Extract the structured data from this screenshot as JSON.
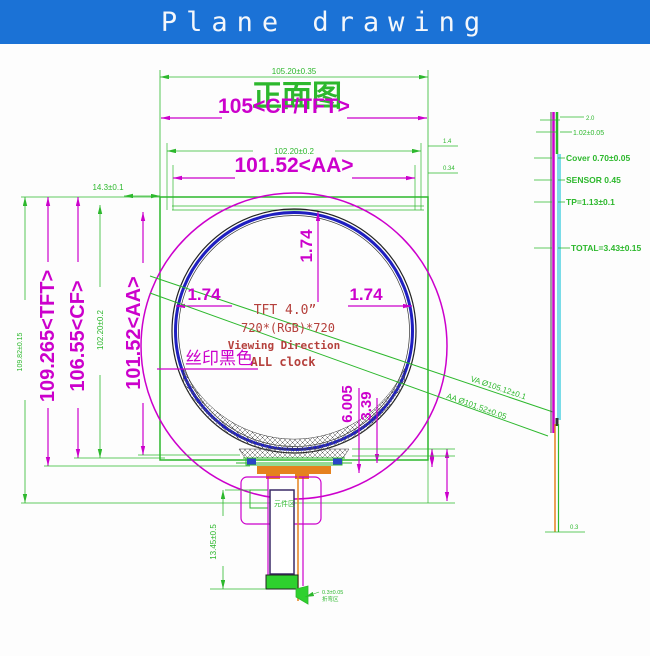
{
  "header": {
    "title": "Plane drawing",
    "bg_color": "#1b72d6"
  },
  "colors": {
    "green": "#2db82d",
    "magenta": "#cc00cc",
    "red_text": "#b5403c",
    "blue_ring": "#1f1fc0",
    "cyan": "#7adce8",
    "orange": "#e5821e"
  },
  "front_view": {
    "view_title": "正面图",
    "dim_top_small": "105.20±0.35",
    "dim_width_cf": "105<CF/TFT>",
    "dim_width_mid_small": "102.20±0.2",
    "dim_width_aa": "101.52<AA>",
    "dim_height_outer_small": "109.82±0.15",
    "dim_height_tft": "109.265<TFT>",
    "dim_height_cf": "106.55<CF>",
    "dim_height_mid_small": "102.20±0.2",
    "dim_height_aa": "101.52<AA>",
    "dim_offset_top_left": "14.3±0.1",
    "dim_gap_top": "1.74",
    "dim_gap_left": "1.74",
    "dim_gap_right": "1.74",
    "dim_edge_tick_upper": "1.4",
    "dim_edge_tick_lower": "0.34",
    "dim_bottom_a": "6.005",
    "dim_bottom_b": "3.39",
    "dim_fpc": "13.45±0.5",
    "leader_va": "VA Ø105.12±0.1",
    "leader_aa": "AA Ø101.52±0.05",
    "panel_line1": "TFT 4.0”",
    "panel_line2": "720*(RGB)*720",
    "panel_line3": "Viewing Direction",
    "panel_line4": "ALL clock",
    "silk_label": "丝印黑色",
    "component_area": "元件区",
    "bend_note1": "0.3±0.05",
    "bend_note2": "折弯区"
  },
  "side_view": {
    "dim_top": "2.0",
    "dim_glass": "1.02±0.05",
    "label_cover": "Cover 0.70±0.05",
    "label_sensor": "SENSOR 0.45",
    "label_tp": "TP=1.13±0.1",
    "label_total": "TOTAL=3.43±0.15",
    "dim_bottom": "0.3"
  }
}
